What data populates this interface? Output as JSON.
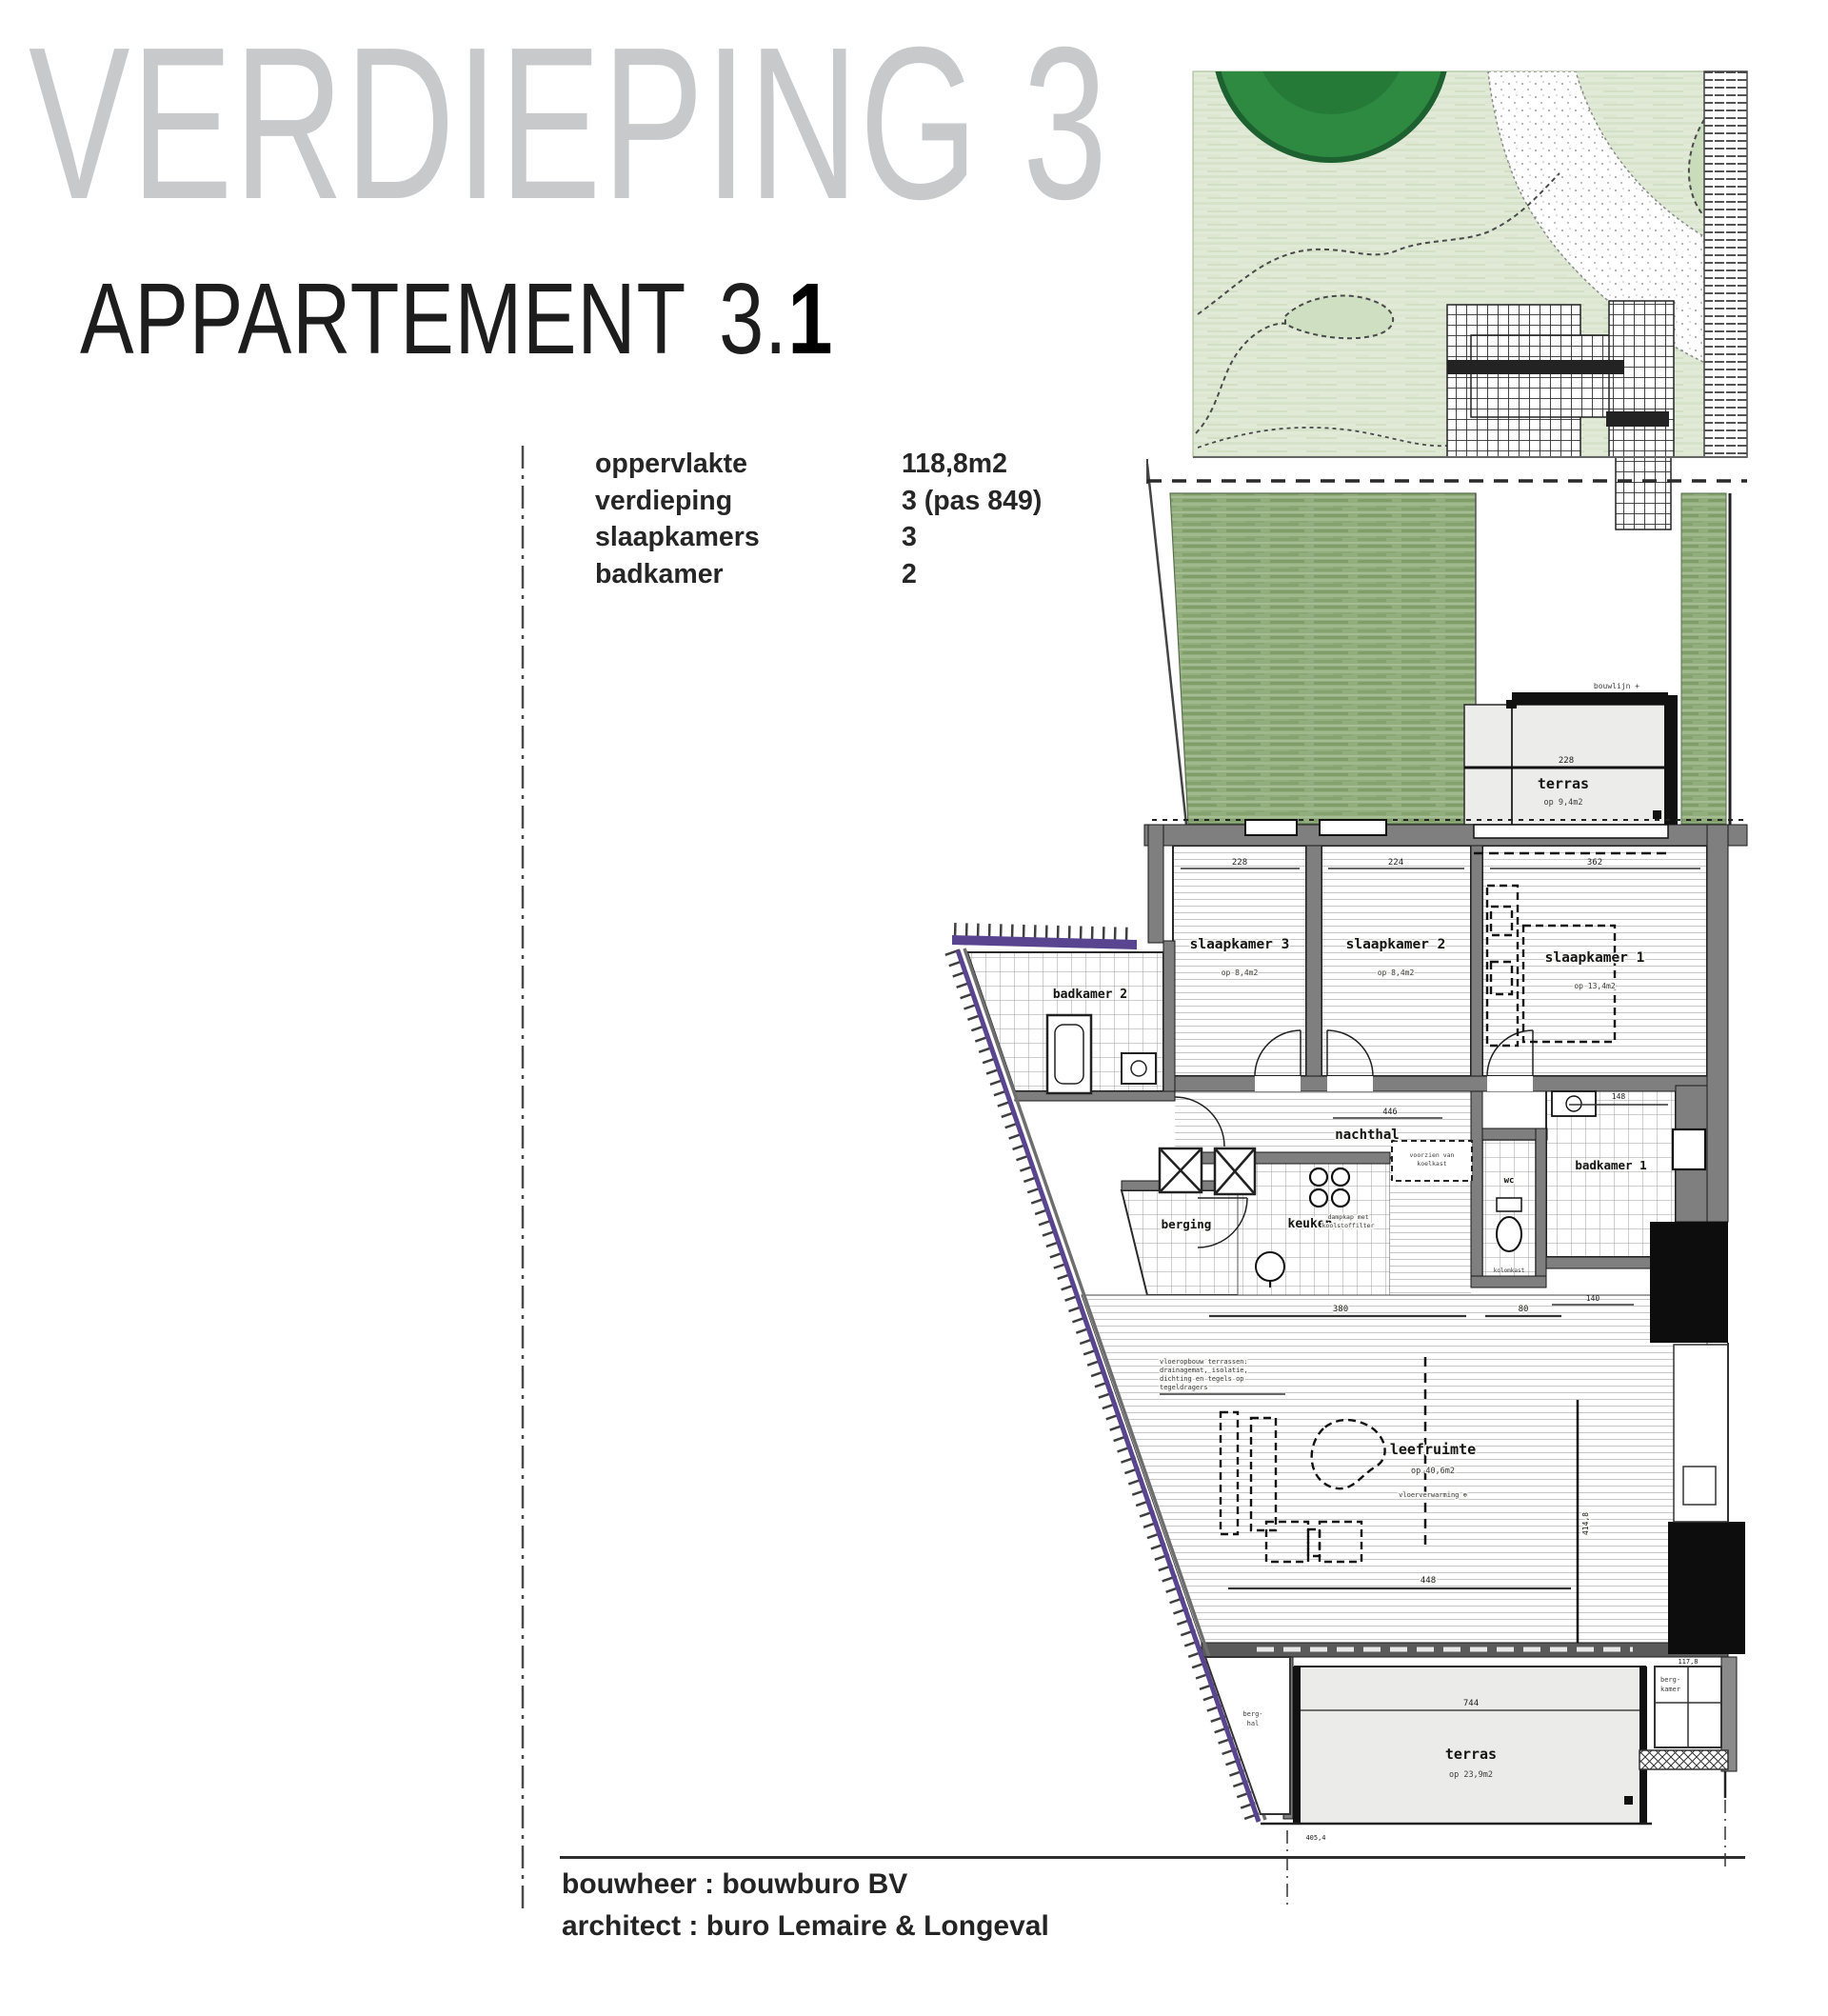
{
  "document": {
    "title": "VERDIEPING 3",
    "apartment_label": "APPARTEMENT 3.",
    "apartment_number": "1"
  },
  "info": {
    "rows": [
      {
        "label": "oppervlakte",
        "value": "118,8m2"
      },
      {
        "label": "verdieping",
        "value": "3 (pas 849)"
      },
      {
        "label": "slaapkamers",
        "value": "3"
      },
      {
        "label": "badkamer",
        "value": "2"
      }
    ]
  },
  "footer": {
    "builder": "bouwheer : bouwburo BV",
    "architect": "architect : buro Lemaire & Longeval"
  },
  "plan": {
    "rooms": {
      "slaapkamer3": {
        "name": "slaapkamer 3",
        "area": "op 8,4m2"
      },
      "slaapkamer2": {
        "name": "slaapkamer 2",
        "area": "op 8,4m2"
      },
      "slaapkamer1": {
        "name": "slaapkamer 1",
        "area": "op 13,4m2"
      },
      "badkamer2": {
        "name": "badkamer 2"
      },
      "badkamer1": {
        "name": "badkamer 1"
      },
      "wc": {
        "name": "wc"
      },
      "nachthal": {
        "name": "nachthal"
      },
      "berging": {
        "name": "berging"
      },
      "keuken": {
        "name": "keuken"
      },
      "leefruimte": {
        "name": "leefruimte",
        "area": "op 40,6m2",
        "note": "vloerverwarming ⊕"
      },
      "terras_upper": {
        "name": "terras",
        "area": "op 9,4m2"
      },
      "terras_lower": {
        "name": "terras",
        "area": "op 23,9m2"
      },
      "berghal": {
        "line1": "berg-",
        "line2": "hal"
      },
      "bergkamer": {
        "line1": "berg-",
        "line2": "kamer"
      }
    },
    "dimensions": {
      "slaapkamer3_breedte": "228",
      "slaapkamer2_breedte": "224",
      "slaapkamer1_breedte": "362",
      "nachthal_lengte": "446",
      "terras_upper_breedte": "228",
      "leefruimte_breedte": "380",
      "leefruimte_breedte2": "80",
      "leefruimte_lengte": "448",
      "leefruimte_hoogte": "414,8",
      "badkamer1_breedte": "148",
      "badkamer1_onder": "140",
      "terras_lower_breedte": "744",
      "bergkamer_maat": "117,8",
      "site_maat": "405,4"
    },
    "annotations": {
      "bouwlijn": "bouwlijn +",
      "dampkap_1": "dampkap met",
      "dampkap_2": "koolstoffilter",
      "koelkast_1": "voorzien van",
      "koelkast_2": "koelkast",
      "kolomkast": "kolomkast",
      "note_1": "vloeropbouw terrassen:",
      "note_2": "drainagemat, isolatie,",
      "note_3": "dichting en tegels op",
      "note_4": "tegeldragers"
    }
  }
}
